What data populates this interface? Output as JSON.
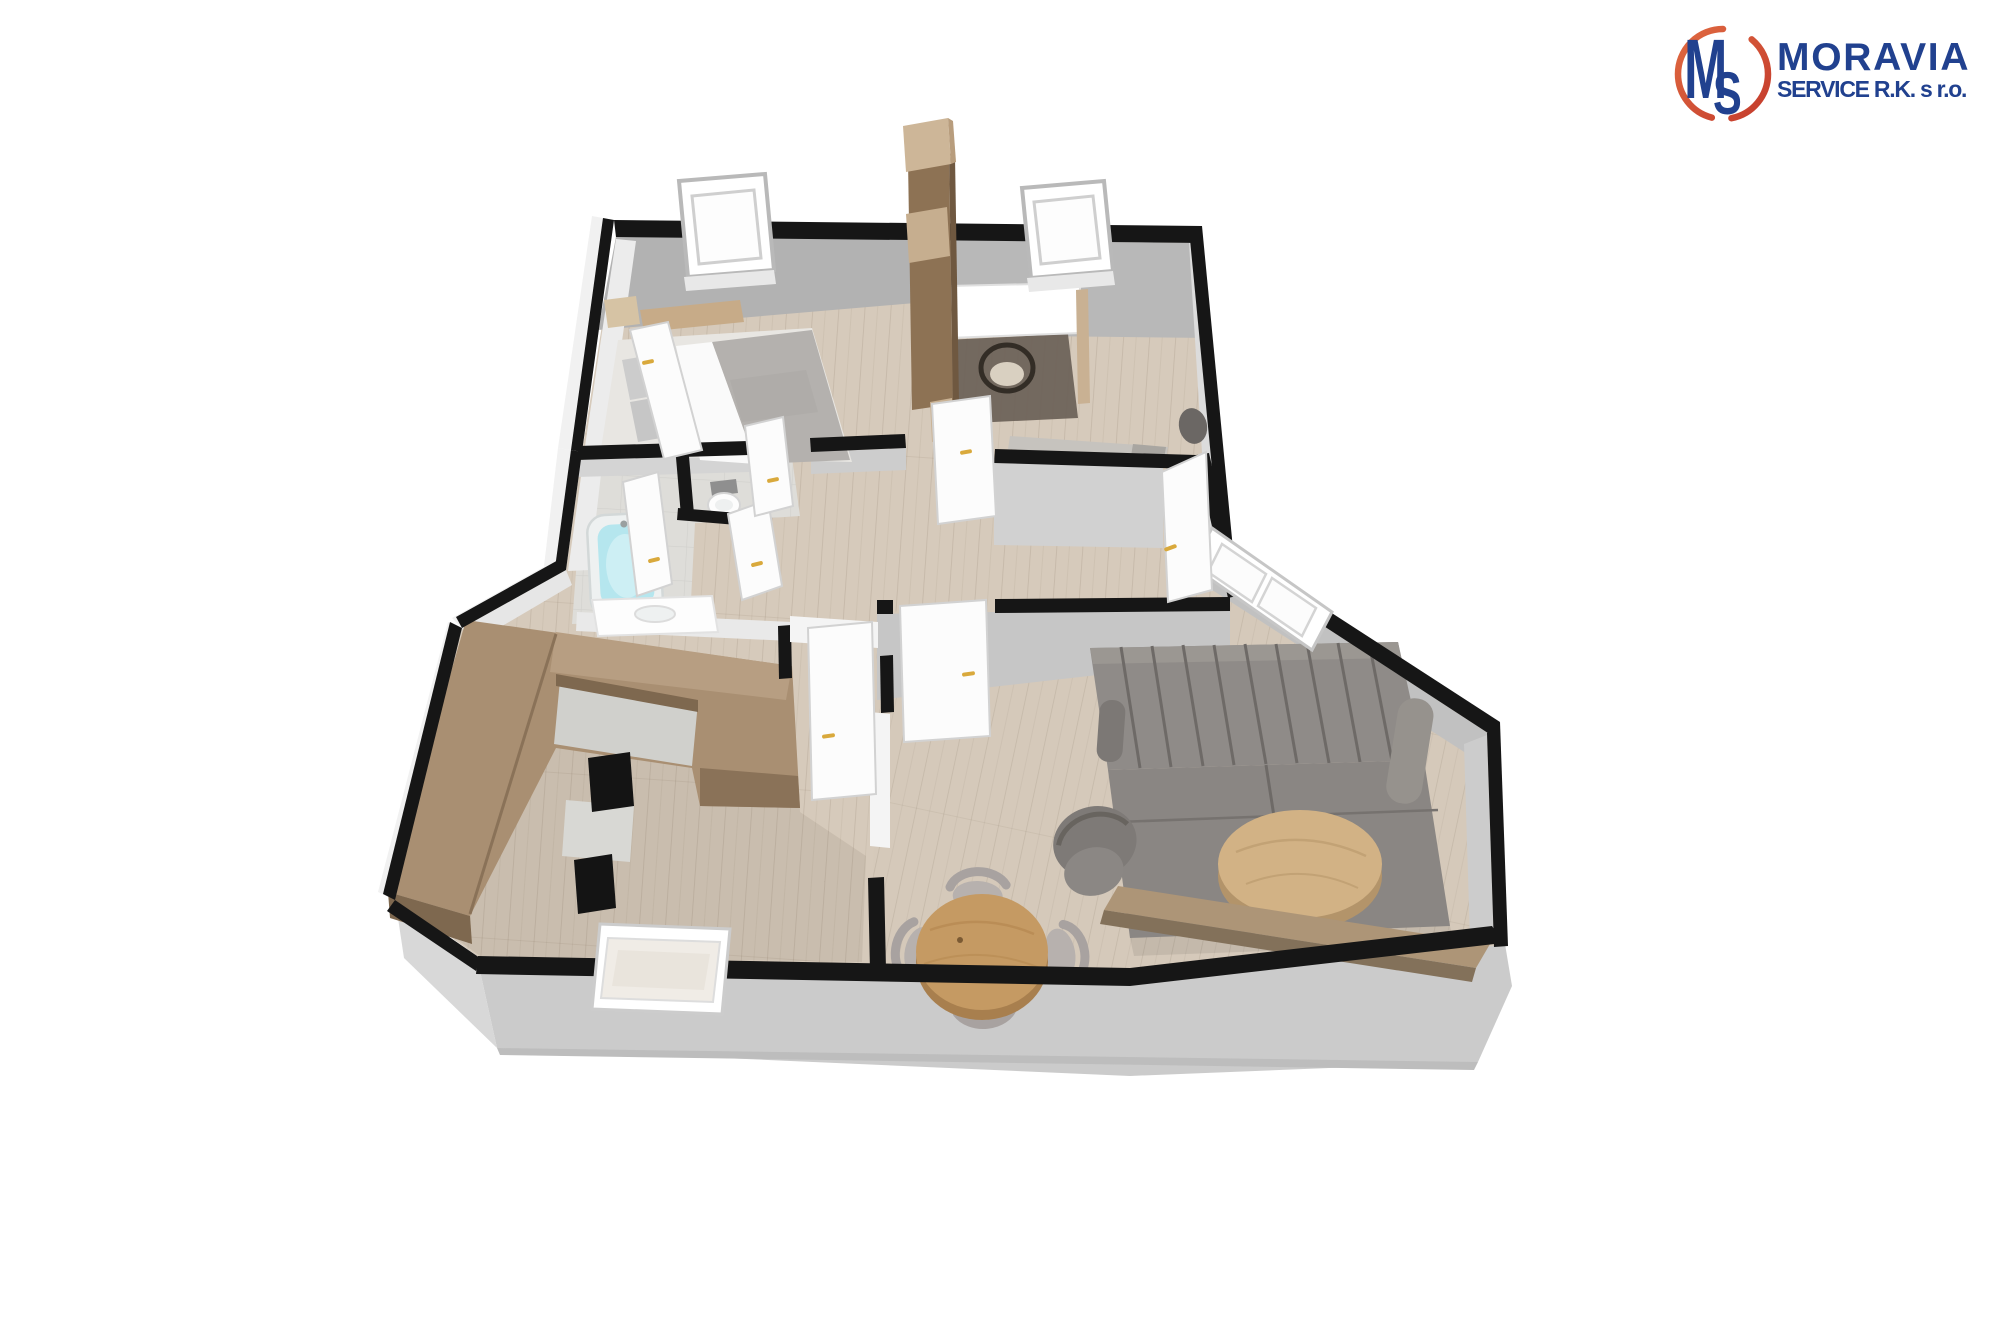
{
  "logo": {
    "monogram": {
      "m": "M",
      "s": "S"
    },
    "title": "MORAVIA",
    "subtitle": "SERVICE R.K. s r.o.",
    "colors": {
      "blue": "#21418f",
      "orange": "#d0503a",
      "orange_light": "#e06a41"
    }
  },
  "floorplan": {
    "view": "3d-top-perspective-render",
    "palette": {
      "wall": "#161616",
      "plinth": "#cbcbcb",
      "wall_face": "#b2b2b2",
      "floor": "#d6cabb",
      "floor_bath": "#deddd9",
      "floor_kitchen": "#c9bdae",
      "floor_living": "#d5c9ba",
      "wood_kitchen": "#a98f72",
      "wood_dining_table": "#c59a63",
      "wood_coffee_table": "#d2b285",
      "wood_sideboard": "#ad9577",
      "wood_wardrobe": "#8d7254",
      "headboard": "#c7ab88",
      "bed_duvet": "#b4b1ae",
      "sofa": "#8f8b88",
      "armchair": "#7e7a77",
      "chair_gray": "#a8a2a0",
      "bath_water": "#b5e6ee",
      "appliance": "#141414",
      "door": "#fcfcfc",
      "door_handle": "#d9a93c"
    },
    "rooms": [
      {
        "name": "bedroom"
      },
      {
        "name": "office-bedroom2"
      },
      {
        "name": "bathroom"
      },
      {
        "name": "wc"
      },
      {
        "name": "hallway"
      },
      {
        "name": "kitchen"
      },
      {
        "name": "dining-area"
      },
      {
        "name": "living-room"
      }
    ],
    "furniture": [
      "double-bed",
      "nightstand",
      "wardrobe-column",
      "desk",
      "desk-chair",
      "office-bench",
      "bathtub",
      "washbasin-vanity",
      "toilet",
      "u-shaped-kitchen-counter",
      "built-in-oven",
      "built-in-appliance",
      "dining-table",
      "dining-chair",
      "sofa",
      "armchair",
      "coffee-table",
      "sideboard"
    ],
    "openings": {
      "windows": 4,
      "door_leaves": 8
    }
  }
}
